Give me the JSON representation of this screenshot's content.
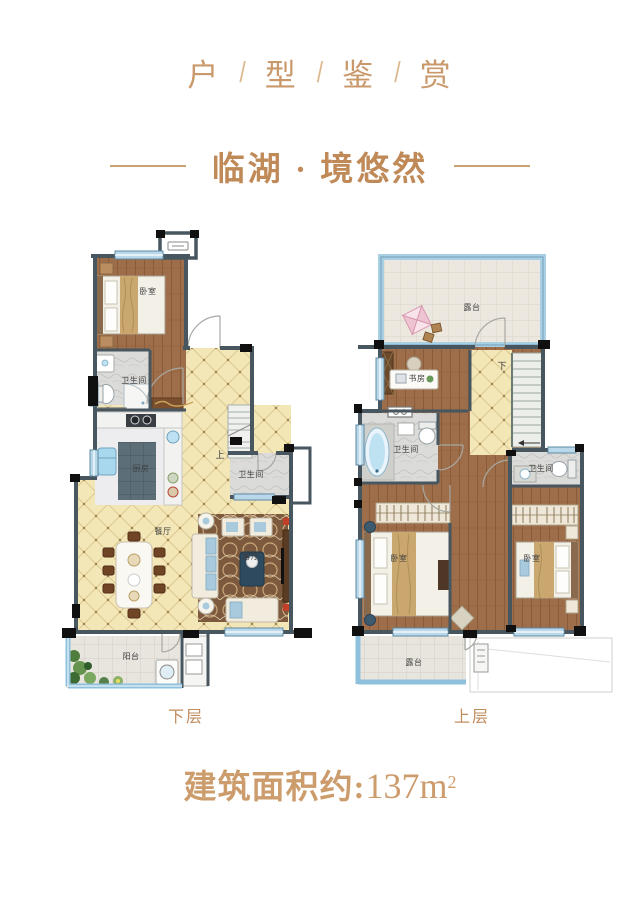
{
  "colors": {
    "accent": "#c9996c",
    "subtitle": "#bf8a58",
    "wall": "#47565f",
    "window": "#aed3e6",
    "wood": "#9e6d49",
    "tile": "#f3e6b7",
    "label": "#3f3f3f"
  },
  "header": {
    "chars": [
      "户",
      "型",
      "鉴",
      "赏"
    ],
    "sep": "/"
  },
  "subtitle": {
    "text": "临湖 · 境悠然"
  },
  "plans": {
    "lower": {
      "caption": "下层",
      "stairs": "上",
      "rooms": {
        "bedroom": "卧室",
        "bath_upper": "卫生间",
        "kitchen": "厨房",
        "dining": "餐厅",
        "living": "客厅",
        "bath_mid": "卫生间",
        "balcony": "阳台"
      }
    },
    "upper": {
      "caption": "上层",
      "stairs": "下",
      "rooms": {
        "terrace_top": "露台",
        "study": "书房",
        "bath_left": "卫生间",
        "bath_right": "卫生间",
        "bedroom_left": "卧室",
        "bedroom_right": "卧室",
        "terrace_bottom": "露台"
      }
    }
  },
  "footer": {
    "area_label": "建筑面积约:",
    "area_value": "137m",
    "area_sup": "2"
  }
}
